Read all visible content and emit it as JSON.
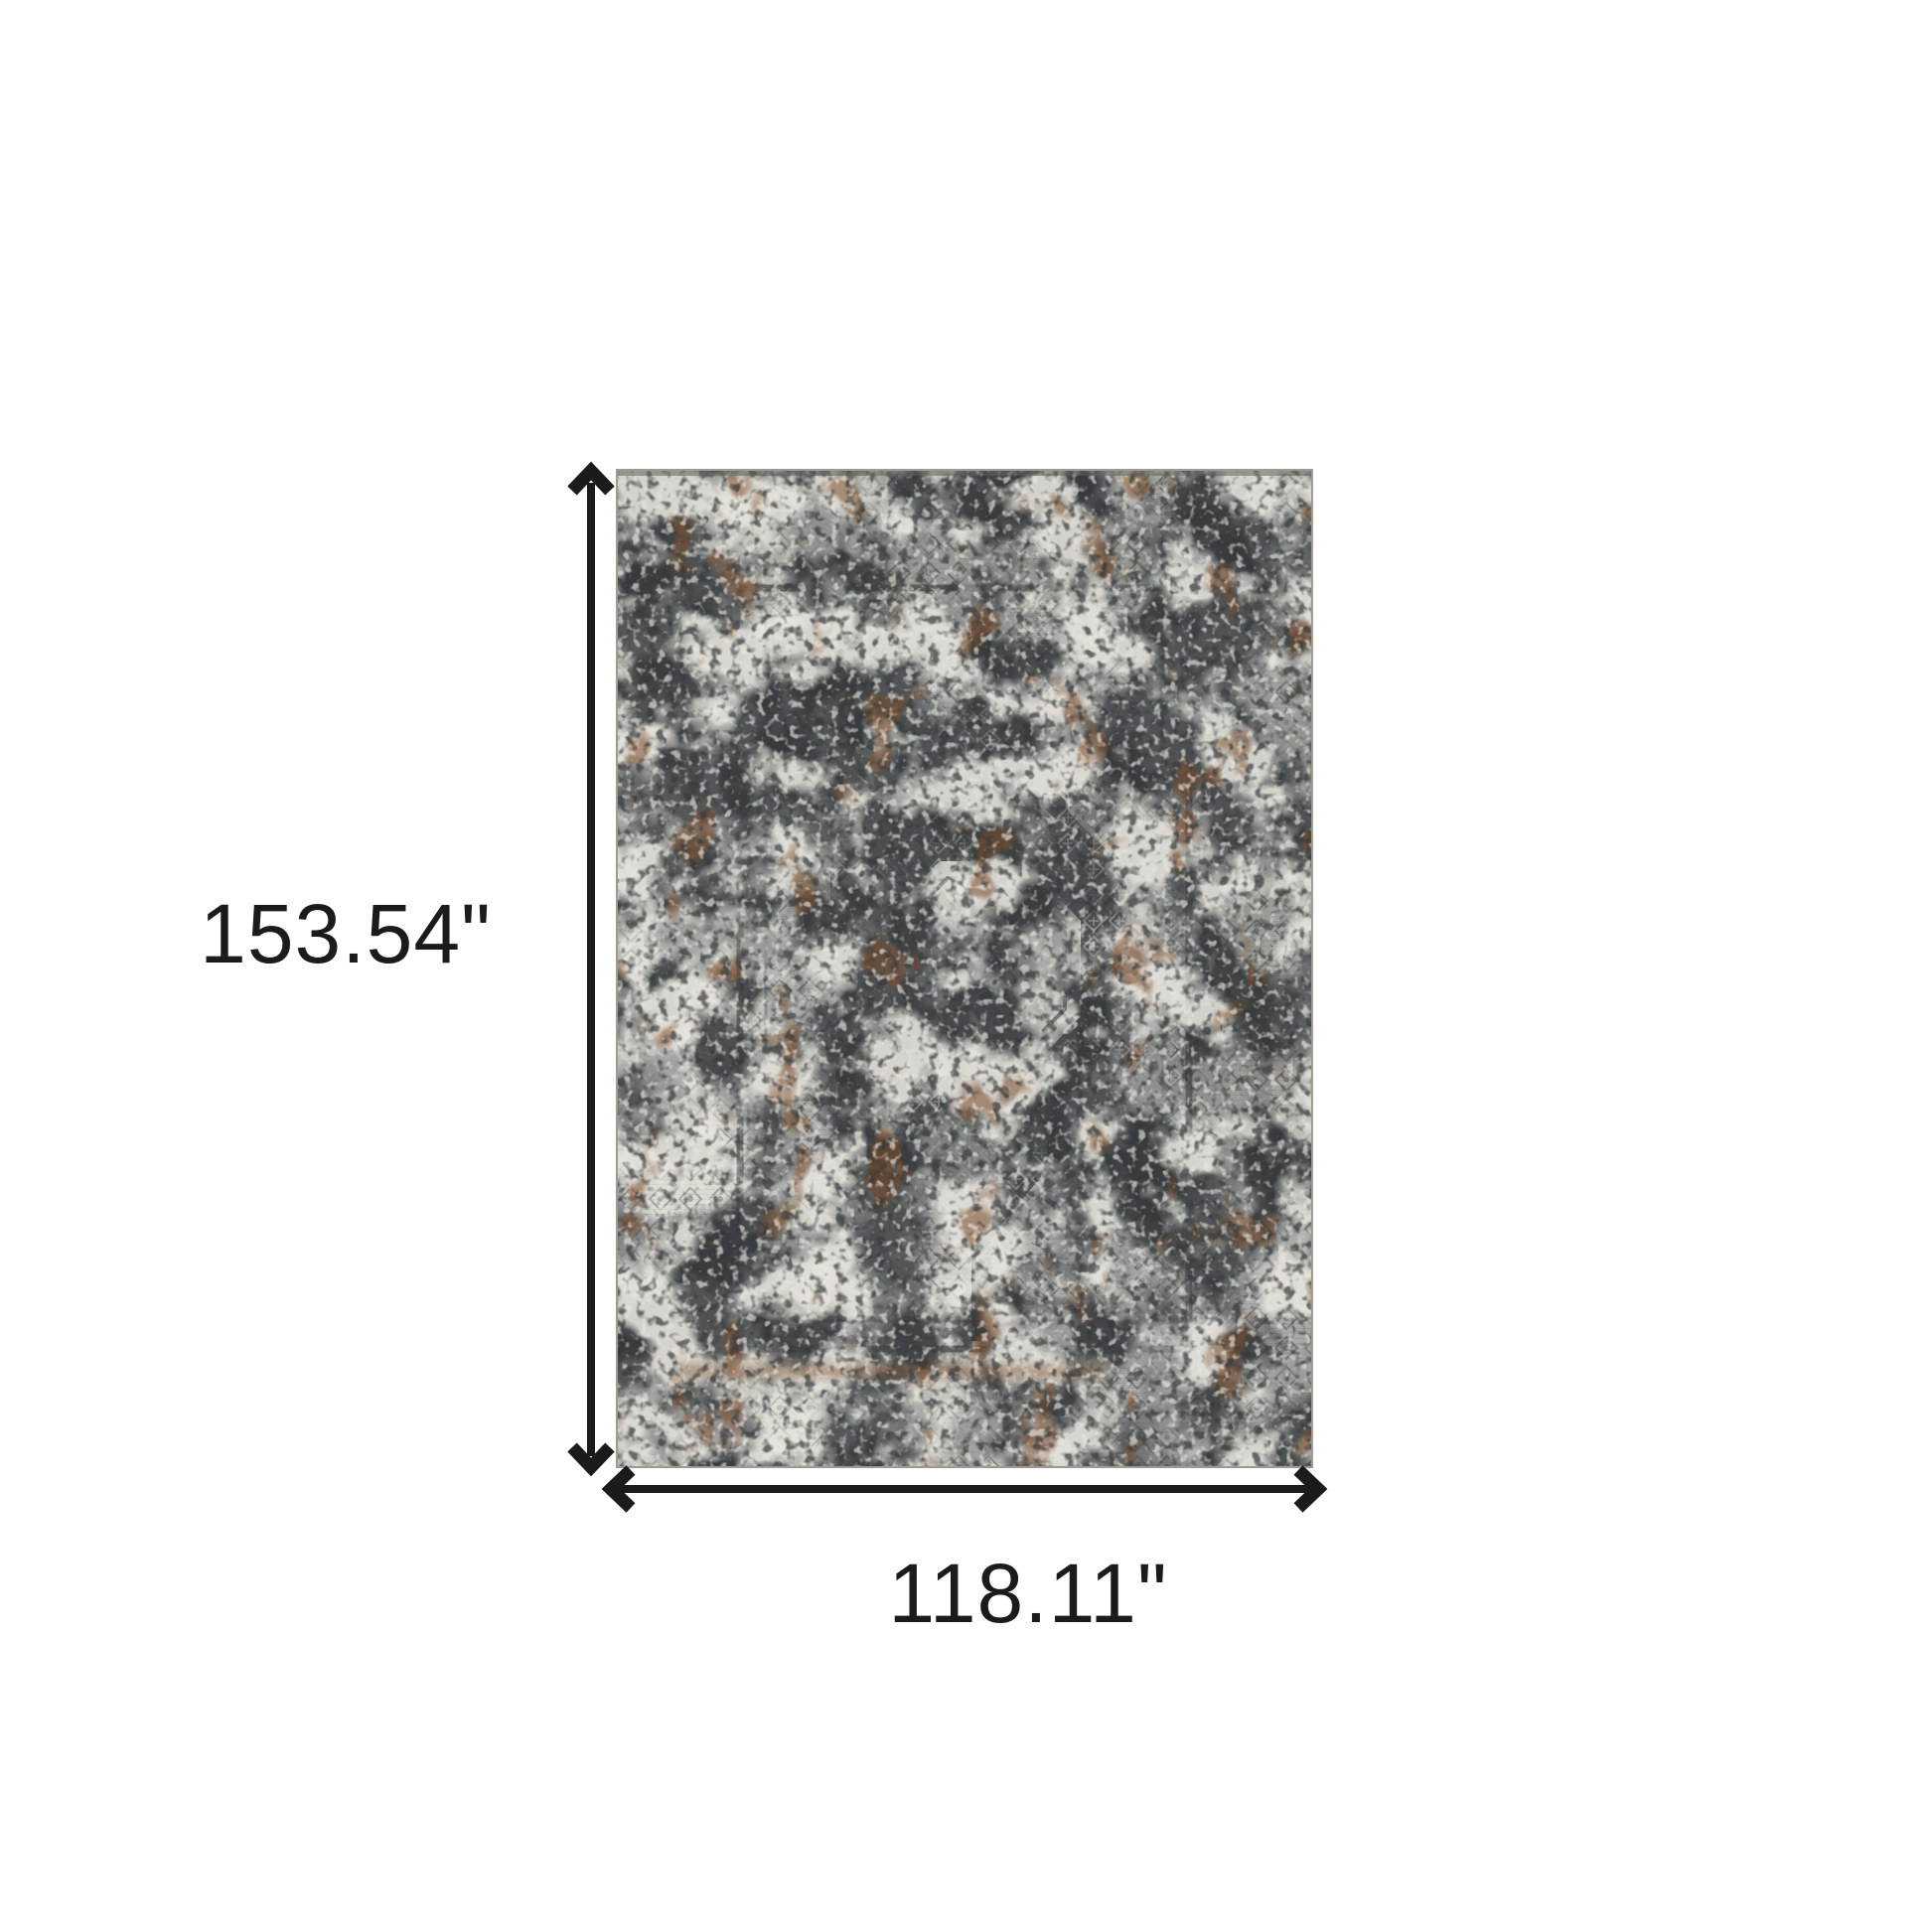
{
  "diagram": {
    "height_label": "153.54\"",
    "width_label": "118.11\"",
    "subject": "distressed gray medallion area rug, top view"
  },
  "colors": {
    "background": "#ffffff",
    "dimension": "#1b1b1b",
    "rug_base": "#d9d8d1",
    "rug_ivory": "#e7e5de",
    "rug_gray": "#8d908e",
    "rug_dark": "#474b4e",
    "rug_charcoal": "#34383a",
    "rug_rust": "#7d4e2a",
    "rug_edge": "#9b9a93"
  }
}
